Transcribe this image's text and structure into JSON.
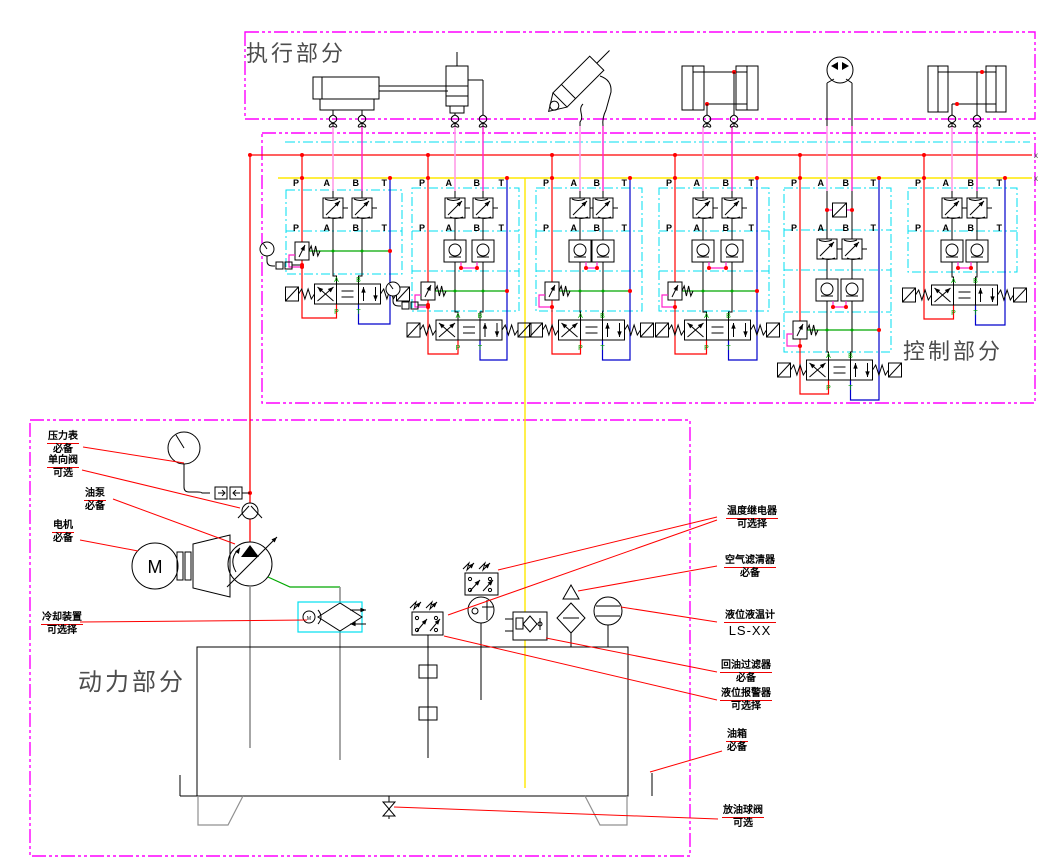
{
  "sections": {
    "execution": {
      "title": "执行部分"
    },
    "control": {
      "title": "控制部分"
    },
    "power": {
      "title": "动力部分"
    }
  },
  "bus": {
    "port_labels": [
      "P",
      "A",
      "B",
      "T"
    ],
    "line_end_mark": "x"
  },
  "stations": [
    {
      "id": 1,
      "variant": "throttle_relief",
      "ports": [
        "P",
        "A",
        "B",
        "T"
      ],
      "has_gauge": true
    },
    {
      "id": 2,
      "variant": "throttle_check_relief",
      "ports": [
        "P",
        "A",
        "B",
        "T"
      ],
      "has_gauge": true
    },
    {
      "id": 3,
      "variant": "throttle_check_relief",
      "ports": [
        "P",
        "A",
        "B",
        "T"
      ],
      "has_gauge": false
    },
    {
      "id": 4,
      "variant": "throttle_check_relief",
      "ports": [
        "P",
        "A",
        "B",
        "T"
      ],
      "has_gauge": false
    },
    {
      "id": 5,
      "variant": "counterbalance_check_relief",
      "ports": [
        "P",
        "A",
        "B",
        "T"
      ],
      "has_gauge": false
    },
    {
      "id": 6,
      "variant": "throttle_check",
      "ports": [
        "P",
        "A",
        "B",
        "T"
      ],
      "has_gauge": false
    }
  ],
  "actuators": [
    "single-rod-cylinder",
    "vertical-cylinder",
    "hydraulic-breaker",
    "twin-cylinders",
    "hydraulic-motor",
    "twin-cylinders"
  ],
  "power_components": {
    "motor_letter": "M",
    "fan_motor_letter": "M"
  },
  "callouts": [
    {
      "id": "pressure-gauge",
      "lines": [
        "压力表",
        "必备"
      ]
    },
    {
      "id": "check-valve",
      "lines": [
        "单向阀",
        "可选"
      ]
    },
    {
      "id": "oil-pump",
      "lines": [
        "油泵",
        "必备"
      ]
    },
    {
      "id": "electric-motor",
      "lines": [
        "电机",
        "必备"
      ]
    },
    {
      "id": "cooler",
      "lines": [
        "冷却装置",
        "可选择"
      ]
    },
    {
      "id": "temp-relay",
      "lines": [
        "温度继电器",
        "可选择"
      ]
    },
    {
      "id": "air-filter",
      "lines": [
        "空气滤清器",
        "必备"
      ]
    },
    {
      "id": "level-temp-gauge",
      "lines": [
        "液位液温计",
        "LS-XX"
      ]
    },
    {
      "id": "return-filter",
      "lines": [
        "回油过滤器",
        "必备"
      ]
    },
    {
      "id": "level-alarm",
      "lines": [
        "液位报警器",
        "可选择"
      ]
    },
    {
      "id": "oil-tank",
      "lines": [
        "油箱",
        "必备"
      ]
    },
    {
      "id": "drain-ball-valve",
      "lines": [
        "放油球阀",
        "可选"
      ]
    }
  ],
  "colors": {
    "section_border": "#ff00ff",
    "group_box": "#00dff0",
    "pressure_line": "#ff0000",
    "return_line": "#0000cc",
    "drain_line": "#ffe800",
    "pilot_line_a": "#ff9ce8",
    "pilot_line_b": "#ff22cc",
    "green_line": "#00a800",
    "leader": "#ff0000",
    "suction": "#909090"
  }
}
